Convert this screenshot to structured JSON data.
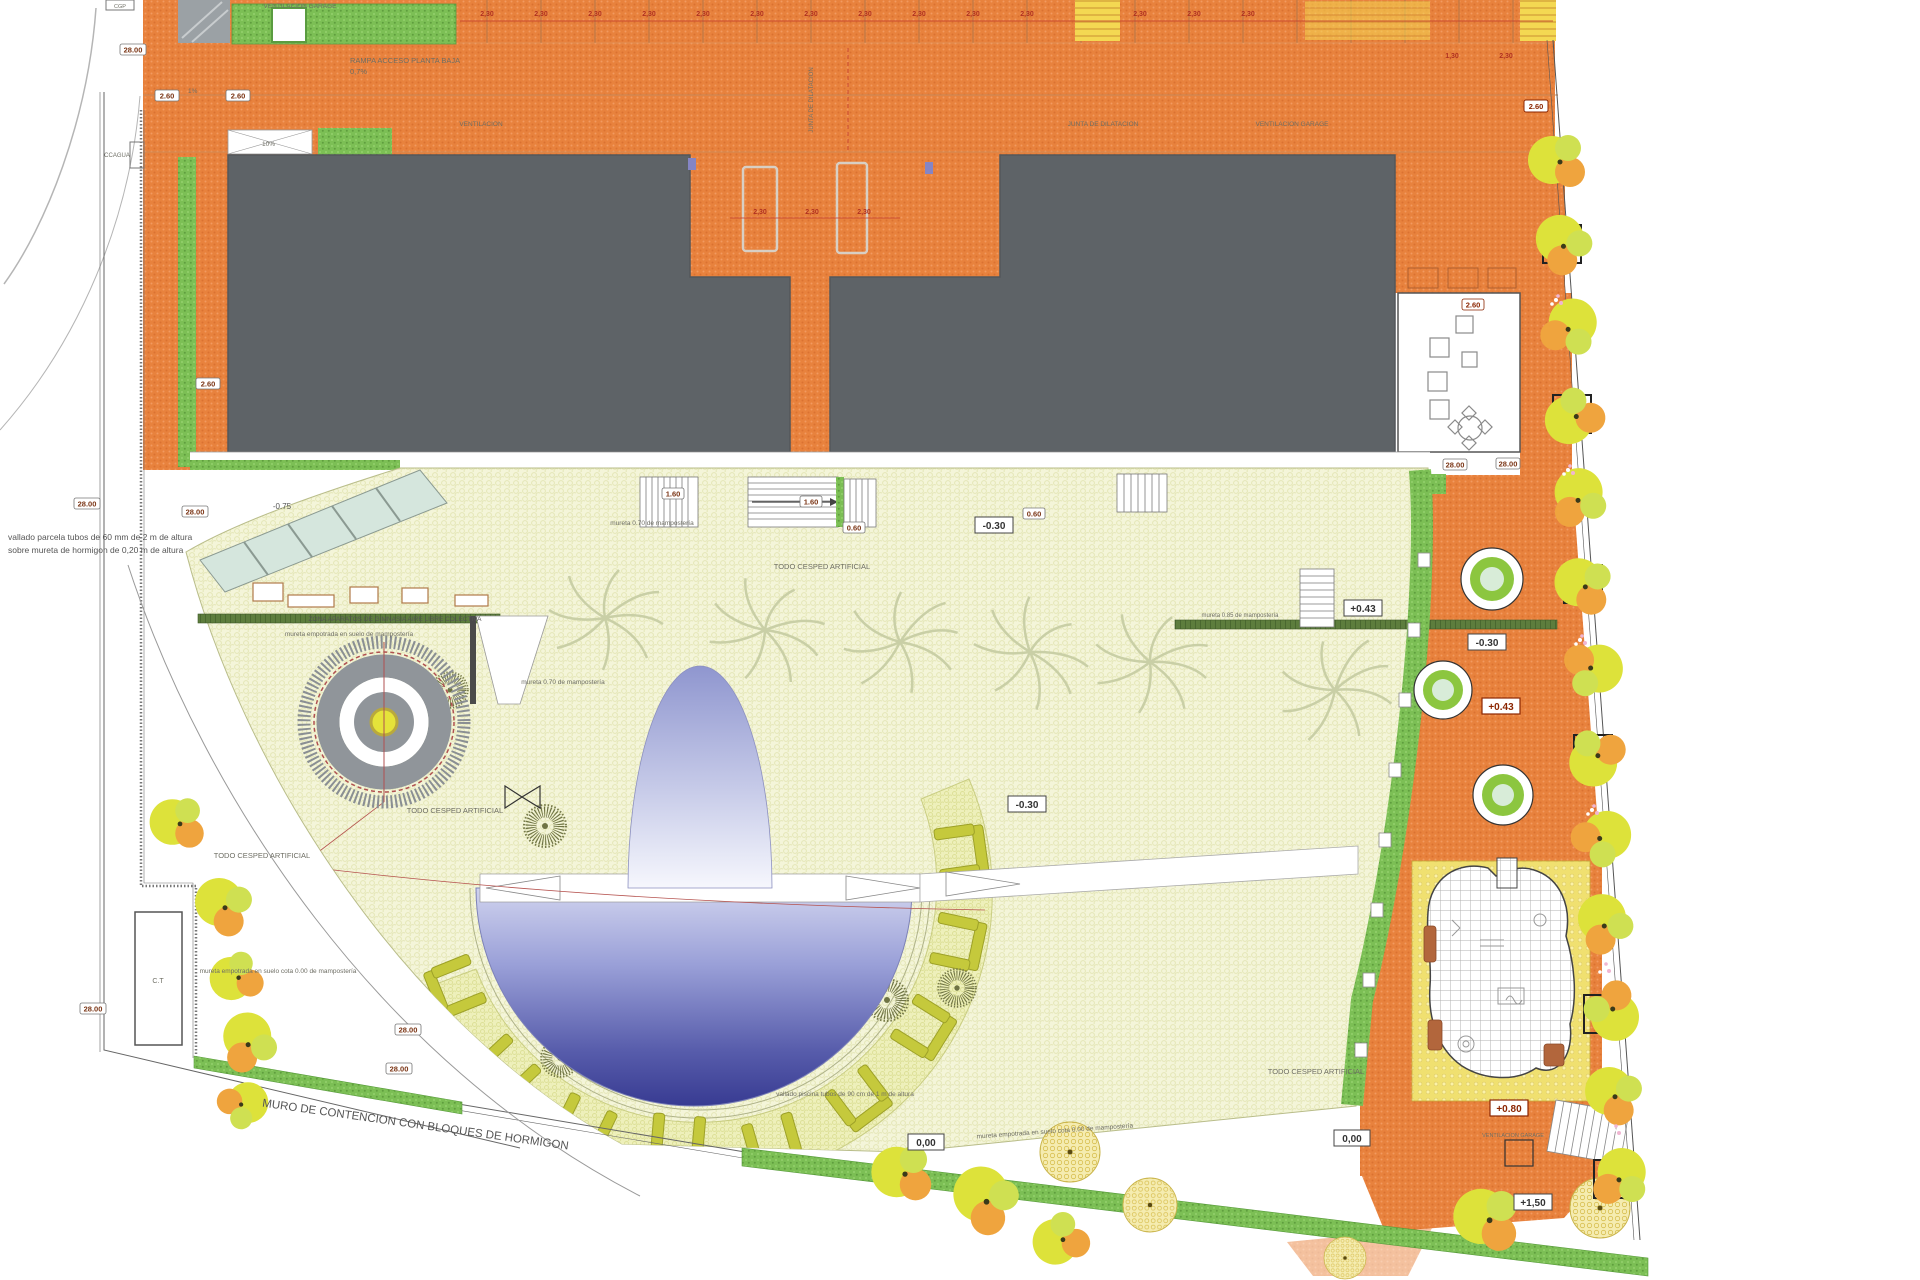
{
  "palette": {
    "paving_orange": "#e8823d",
    "roof_gray": "#5e6367",
    "plaza_cream": "#f4f5d9",
    "bench_band": "#eef0bb",
    "hedge_green": "#7cbf55",
    "pool_deep_blue": "#383b92",
    "pool_light_blue": "#d0d3ee",
    "tree_yellow": "#dde23a",
    "tree_orange": "#efa43e",
    "accent_red": "#c0392b"
  },
  "labels": {
    "ventilacion_garage": "VENTILACION GARAGE",
    "rampa_acceso": "RAMPA ACCESO PLANTA BAJA",
    "rampa_pendiente": "0,7%",
    "ventilacion": "VENTILACION",
    "junta_dilatacion": "JUNTA DE DILATACION",
    "ccagua": "CCAGUA",
    "cgp": "CGP",
    "vallado_parcela_1": "vallado parcela tubos de 60 mm de 2 m de altura",
    "vallado_parcela_2": "sobre mureta de hormigon de 0,20 m de altura",
    "zona_aparatos": "ZONA APARATOS DE GIMNASIA AIRE LIBRE COLECTIVA",
    "mureta_empotrada": "mureta empotrada en suelo de mampostería",
    "mureta_070": "mureta 0.70 de mampostería",
    "mureta_085": "mureta 0.85 de mampostería",
    "todo_cesped": "TODO CESPED ARTIFICIAL",
    "muro_contencion": "MURO DE CONTENCION  CON BLOQUES DE HORMIGON",
    "vallado_piscina": "vallado piscina tubos de 90 cm de 1 m de altura",
    "mureta_cota_000": "mureta empotrada en suelo cota 0.00 de mampostería",
    "ct": "C.T",
    "pct10": "10%",
    "pct1": "1%"
  },
  "elevations": {
    "m075": "-0.75",
    "m030": "-0.30",
    "z000": "0,00",
    "p043": "+0.43",
    "p080": "+0.80",
    "p150": "+1,50"
  },
  "dimensions": {
    "d230": "2,30",
    "d130": "1,30",
    "d260": "2.60",
    "d2800": "28.00",
    "d160": "1.60",
    "d060": "0.60"
  }
}
